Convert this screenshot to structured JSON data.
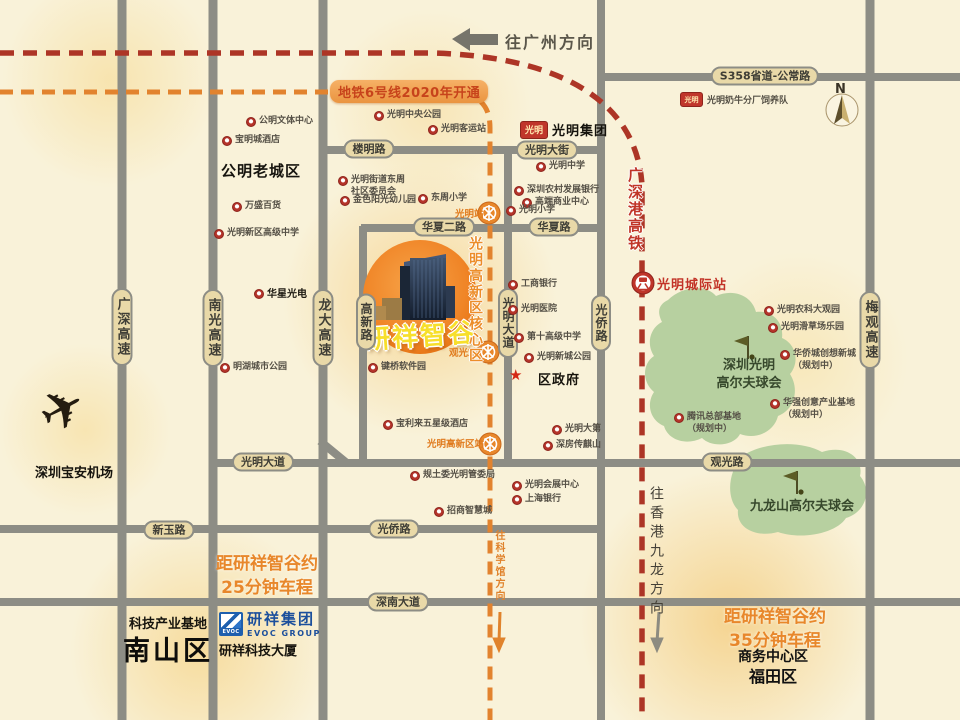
{
  "project": {
    "name": "研祥智谷"
  },
  "banner": {
    "text": "地铁6号线2020年开通"
  },
  "brands": {
    "guangming_logo": "光明",
    "guangming_group": "光明集团",
    "dairy": "光明奶牛分厂饲养队",
    "evoc_logo": "EVOC",
    "evoc_cn": "研祥集团",
    "evoc_en": "EVOC GROUP"
  },
  "colors": {
    "background": "#f9f2d9",
    "road": "#8d8d85",
    "capsule": "#e9d9a8",
    "metro_line": "#e2832e",
    "hsr_line": "#ad3526",
    "project_circle": "#f08527",
    "project_text": "#f7df2b",
    "promo_orange": "#e8872b",
    "golf_green": "#b7d0a0",
    "poi_red": "#b5342a",
    "evoc_blue": "#1e5fae"
  },
  "layers": {
    "roadLabels": [
      {
        "t": "S358省道-公常路",
        "x": 765,
        "y": 76,
        "n": "road-label-s358"
      },
      {
        "t": "楼明路",
        "x": 369,
        "y": 149
      },
      {
        "t": "光明大街",
        "x": 547,
        "y": 150
      },
      {
        "t": "华夏二路",
        "x": 444,
        "y": 227
      },
      {
        "t": "华夏路",
        "x": 554,
        "y": 227
      },
      {
        "t": "光明大道",
        "x": 263,
        "y": 462
      },
      {
        "t": "观光路",
        "x": 727,
        "y": 462
      },
      {
        "t": "新玉路",
        "x": 169,
        "y": 530
      },
      {
        "t": "光侨路",
        "x": 394,
        "y": 529
      },
      {
        "t": "深南大道",
        "x": 398,
        "y": 602
      },
      {
        "t": "广深高速",
        "x": 122,
        "y": 327,
        "v": 1,
        "hw": 1
      },
      {
        "t": "南光高速",
        "x": 213,
        "y": 328,
        "v": 1,
        "hw": 1
      },
      {
        "t": "龙大高速",
        "x": 323,
        "y": 328,
        "v": 1,
        "hw": 1
      },
      {
        "t": "高新路",
        "x": 366,
        "y": 322,
        "v": 1
      },
      {
        "t": "光明大道",
        "x": 508,
        "y": 323,
        "v": 1
      },
      {
        "t": "光侨路",
        "x": 601,
        "y": 323,
        "v": 1
      },
      {
        "t": "梅观高速",
        "x": 870,
        "y": 330,
        "v": 1,
        "hw": 1
      }
    ],
    "pois": [
      {
        "t": "公明文体中心",
        "x": 246,
        "y": 116
      },
      {
        "t": "宝明城酒店",
        "x": 222,
        "y": 135
      },
      {
        "t": "万盛百货",
        "x": 232,
        "y": 201
      },
      {
        "t": "光明新区高级中学",
        "x": 214,
        "y": 228
      },
      {
        "t": "光明中央公园",
        "x": 374,
        "y": 110
      },
      {
        "t": "光明客运站",
        "x": 428,
        "y": 124
      },
      {
        "t": "光明街道东周\n社区委员会",
        "x": 338,
        "y": 175
      },
      {
        "t": "金色阳光幼儿园",
        "x": 340,
        "y": 195
      },
      {
        "t": "东周小学",
        "x": 418,
        "y": 193
      },
      {
        "t": "光明中学",
        "x": 536,
        "y": 161
      },
      {
        "t": "深圳农村发展银行",
        "x": 514,
        "y": 185
      },
      {
        "t": "高端商业中心",
        "x": 522,
        "y": 197
      },
      {
        "t": "光明小学",
        "x": 506,
        "y": 205
      },
      {
        "t": "华星光电",
        "x": 254,
        "y": 288,
        "b": 1
      },
      {
        "t": "明湖城市公园",
        "x": 220,
        "y": 362
      },
      {
        "t": "键桥软件园",
        "x": 368,
        "y": 362
      },
      {
        "t": "宝利来五星级酒店",
        "x": 383,
        "y": 419
      },
      {
        "t": "工商银行",
        "x": 508,
        "y": 279
      },
      {
        "t": "光明医院",
        "x": 508,
        "y": 304
      },
      {
        "t": "第十高级中学",
        "x": 514,
        "y": 332
      },
      {
        "t": "光明新城公园",
        "x": 524,
        "y": 352
      },
      {
        "t": "光明大第",
        "x": 552,
        "y": 424
      },
      {
        "t": "深房传麒山",
        "x": 543,
        "y": 440
      },
      {
        "t": "规土委光明管委局",
        "x": 410,
        "y": 470
      },
      {
        "t": "光明会展中心",
        "x": 512,
        "y": 480
      },
      {
        "t": "上海银行",
        "x": 512,
        "y": 494
      },
      {
        "t": "招商智慧城",
        "x": 434,
        "y": 506
      },
      {
        "t": "光明农科大观园",
        "x": 764,
        "y": 305
      },
      {
        "t": "光明滑草场乐园",
        "x": 768,
        "y": 322
      },
      {
        "t": "华侨城创想新城\n（规划中）",
        "x": 780,
        "y": 349
      },
      {
        "t": "华强创意产业基地\n（规划中）",
        "x": 770,
        "y": 398
      },
      {
        "t": "腾讯总部基地\n（规划中）",
        "x": 674,
        "y": 412
      }
    ],
    "stations": [
      {
        "t": "光明站",
        "x": 455,
        "y": 206,
        "n": "metro-station-guangming"
      },
      {
        "t": "观光站",
        "x": 449,
        "y": 345,
        "n": "metro-station-guanguang"
      },
      {
        "t": "光明高新区站",
        "x": 427,
        "y": 436,
        "n": "metro-station-hightech"
      }
    ],
    "texts": [
      {
        "t": "往广州方向",
        "x": 505,
        "y": 29,
        "cls": "dirTop",
        "n": "toward-guangzhou-label"
      },
      {
        "t": "N",
        "x": 835,
        "y": 82,
        "cls": "compassN",
        "n": "compass-n-label"
      },
      {
        "t": "公明老城区",
        "x": 221,
        "y": 160,
        "cls": "dist15",
        "n": "district-gongming-old-town"
      },
      {
        "t": "★",
        "x": 509,
        "y": 366,
        "cls": "star",
        "n": "government-star-icon"
      },
      {
        "t": "区政府",
        "x": 538,
        "y": 369,
        "cls": "gov",
        "n": "district-government-label"
      },
      {
        "t": "光明城际站",
        "x": 657,
        "y": 274,
        "cls": "rail",
        "n": "guangming-intercity-station-label"
      },
      {
        "t": "广深港高铁",
        "x": 625,
        "y": 167,
        "cls": "hsrV",
        "n": "hsr-line-label"
      },
      {
        "t": "光明高新区核心区",
        "x": 465,
        "y": 236,
        "cls": "coreV",
        "n": "hightech-core-zone-label"
      },
      {
        "t": "深圳光明\n高尔夫球会",
        "x": 749,
        "y": 357,
        "cls": "greenT ctr",
        "n": "shenzhen-guangming-golf-label"
      },
      {
        "t": "九龙山高尔夫球会",
        "x": 802,
        "y": 498,
        "cls": "greenT ctr",
        "n": "jiulongshan-golf-label"
      },
      {
        "t": "距研祥智谷约\n25分钟车程",
        "x": 267,
        "y": 553,
        "cls": "promo ctr",
        "n": "drive-time-25min-label"
      },
      {
        "t": "距研祥智谷约\n35分钟车程",
        "x": 775,
        "y": 606,
        "cls": "promo ctr",
        "n": "drive-time-35min-label"
      },
      {
        "t": "商务中心区",
        "x": 773,
        "y": 646,
        "cls": "dist14 ctr",
        "n": "business-center-district-label"
      },
      {
        "t": "福田区",
        "x": 773,
        "y": 663,
        "cls": "dist16 ctr",
        "n": "district-futian-label"
      },
      {
        "t": "科技产业基地",
        "x": 168,
        "y": 613,
        "cls": "dist13 ctr",
        "n": "tech-industry-base-label"
      },
      {
        "t": "南山区",
        "x": 168,
        "y": 629,
        "cls": "dist28 ctr",
        "n": "district-nanshan-label"
      },
      {
        "t": "研祥科技大厦",
        "x": 258,
        "y": 640,
        "cls": "dist13 ctr",
        "n": "evoc-tower-label"
      },
      {
        "t": "深圳宝安机场",
        "x": 74,
        "y": 462,
        "cls": "dist13 ctr",
        "n": "airport-label"
      },
      {
        "t": "往香港九龙方向",
        "x": 646,
        "y": 486,
        "cls": "hkV",
        "n": "toward-hongkong-label"
      },
      {
        "t": "往科学馆方向",
        "x": 491,
        "y": 530,
        "cls": "sciV",
        "n": "toward-science-museum-label"
      }
    ]
  },
  "icons": {
    "plane_glyph": "✈"
  }
}
